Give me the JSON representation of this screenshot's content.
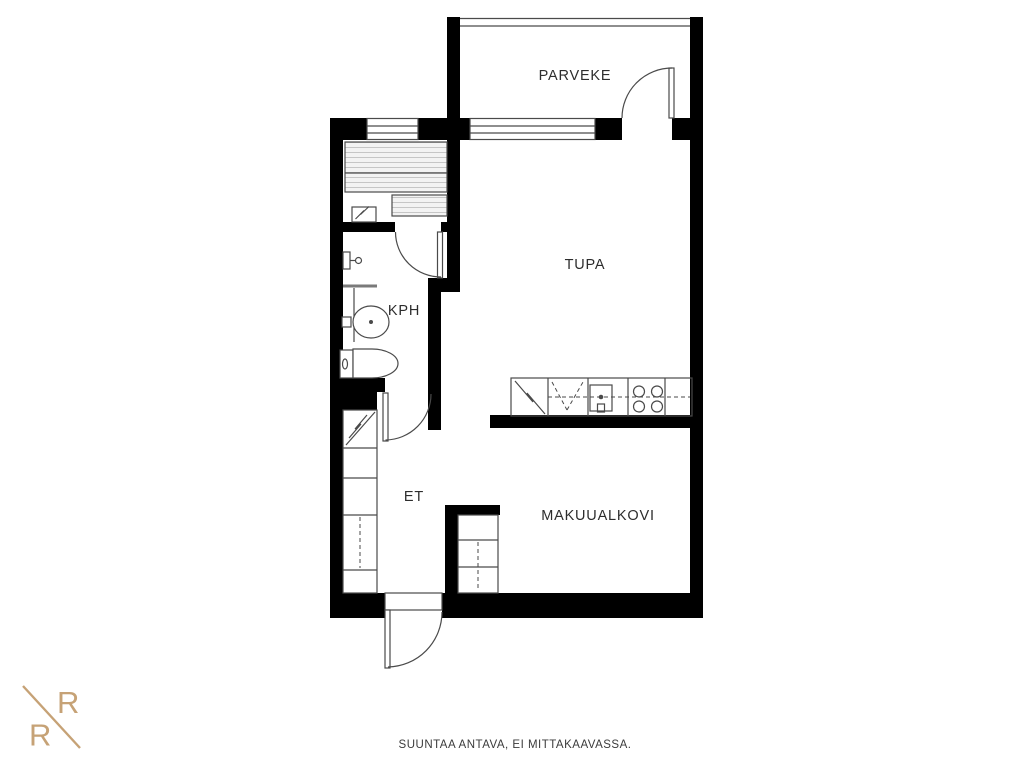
{
  "page": {
    "background": "#ffffff"
  },
  "palette": {
    "wall": "#000000",
    "line": "#4a4a4a",
    "bench_fill": "#f3f3f3",
    "bench_stripe": "#c6c6c6",
    "label_text": "#2d2d2d",
    "footer_text": "#3b3b3b",
    "logo_gold": "#c6a276"
  },
  "rooms": [
    {
      "id": "parveke",
      "label": "PARVEKE"
    },
    {
      "id": "tupa",
      "label": "TUPA"
    },
    {
      "id": "kph",
      "label": "KPH"
    },
    {
      "id": "et",
      "label": "ET"
    },
    {
      "id": "makuualkovi",
      "label": "MAKUUALKOVI"
    }
  ],
  "fixtures": [
    "sauna-benches",
    "sauna-heater",
    "sauna-window",
    "sauna-door",
    "shower-mixer",
    "shower-screen",
    "washbasin",
    "toilet",
    "bathroom-door",
    "wardrobe-hallway",
    "electrical-panel",
    "wardrobe-alcove",
    "refrigerator",
    "dishwasher",
    "kitchen-sink",
    "stove",
    "kitchen-counter",
    "living-room-window",
    "balcony-door",
    "balcony-railing",
    "entrance-door"
  ],
  "logo": {
    "top_letter": "R",
    "bottom_letter": "R"
  },
  "footer": {
    "disclaimer": "SUUNTAA ANTAVA, EI MITTAKAAVASSA."
  }
}
